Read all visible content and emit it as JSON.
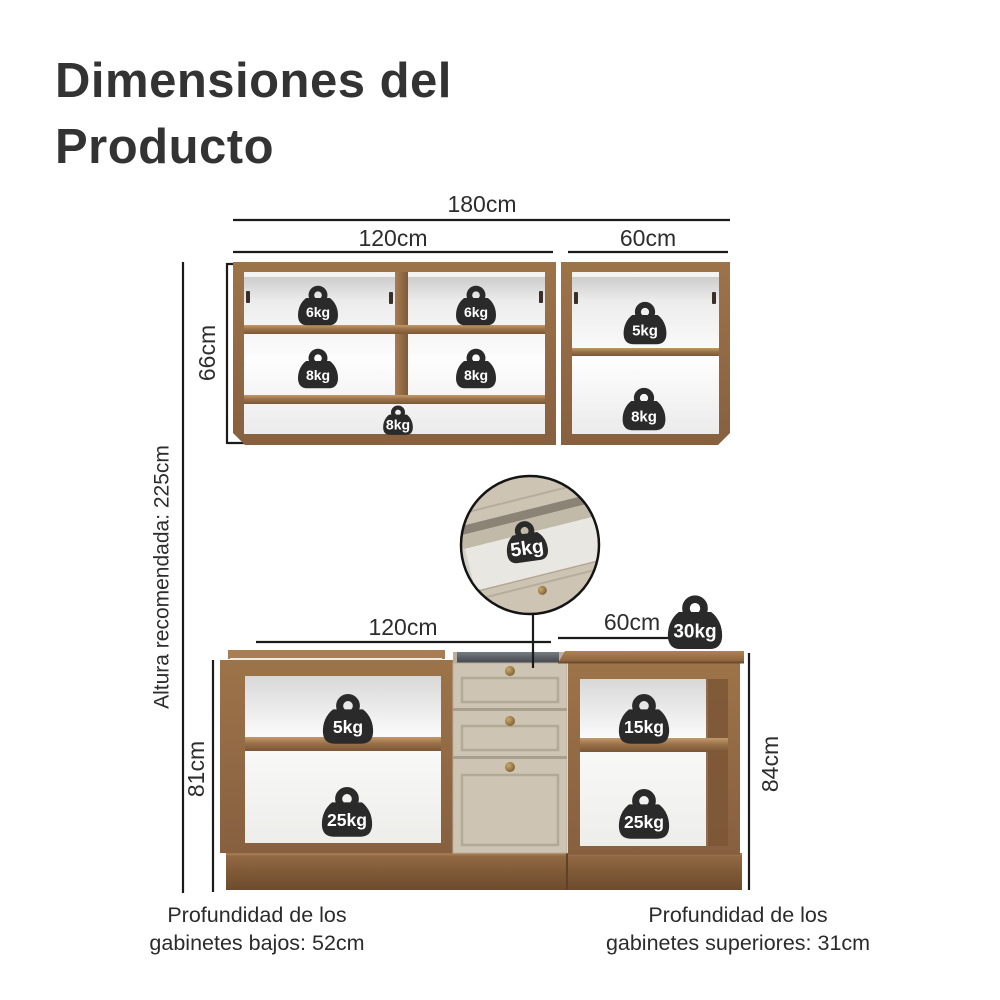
{
  "title": {
    "line1": "Dimensiones del",
    "line2": "Producto"
  },
  "upper_cabinet": {
    "total_width": "180cm",
    "left_width": "120cm",
    "right_width": "60cm",
    "height": "66cm",
    "weights": {
      "top_left": "6kg",
      "top_right": "6kg",
      "middle_left": "8kg",
      "middle_right": "8kg",
      "bottom": "8kg",
      "right_top": "5kg",
      "right_bottom": "8kg"
    }
  },
  "drawer_inset": {
    "weight": "5kg"
  },
  "lower_cabinet": {
    "left_width": "120cm",
    "right_width": "60cm",
    "left_height": "81cm",
    "right_height": "84cm",
    "countertop_weight": "30kg",
    "weights": {
      "left_top": "5kg",
      "left_bottom": "25kg",
      "right_top": "15kg",
      "right_bottom": "25kg"
    }
  },
  "annotations": {
    "recommended_height": "Altura recomendada: 225cm",
    "lower_depth_line1": "Profundidad de los",
    "lower_depth_line2": "gabinetes bajos: 52cm",
    "upper_depth_line1": "Profundidad de los",
    "upper_depth_line2": "gabinetes superiores: 31cm"
  },
  "colors": {
    "wood": "#8f6742",
    "wood_dark": "#75522f",
    "drawer_beige": "#cdc4b3",
    "badge": "#2a2a2a",
    "line": "#1b1b1b",
    "text": "#2d2d2d",
    "title": "#333333"
  }
}
